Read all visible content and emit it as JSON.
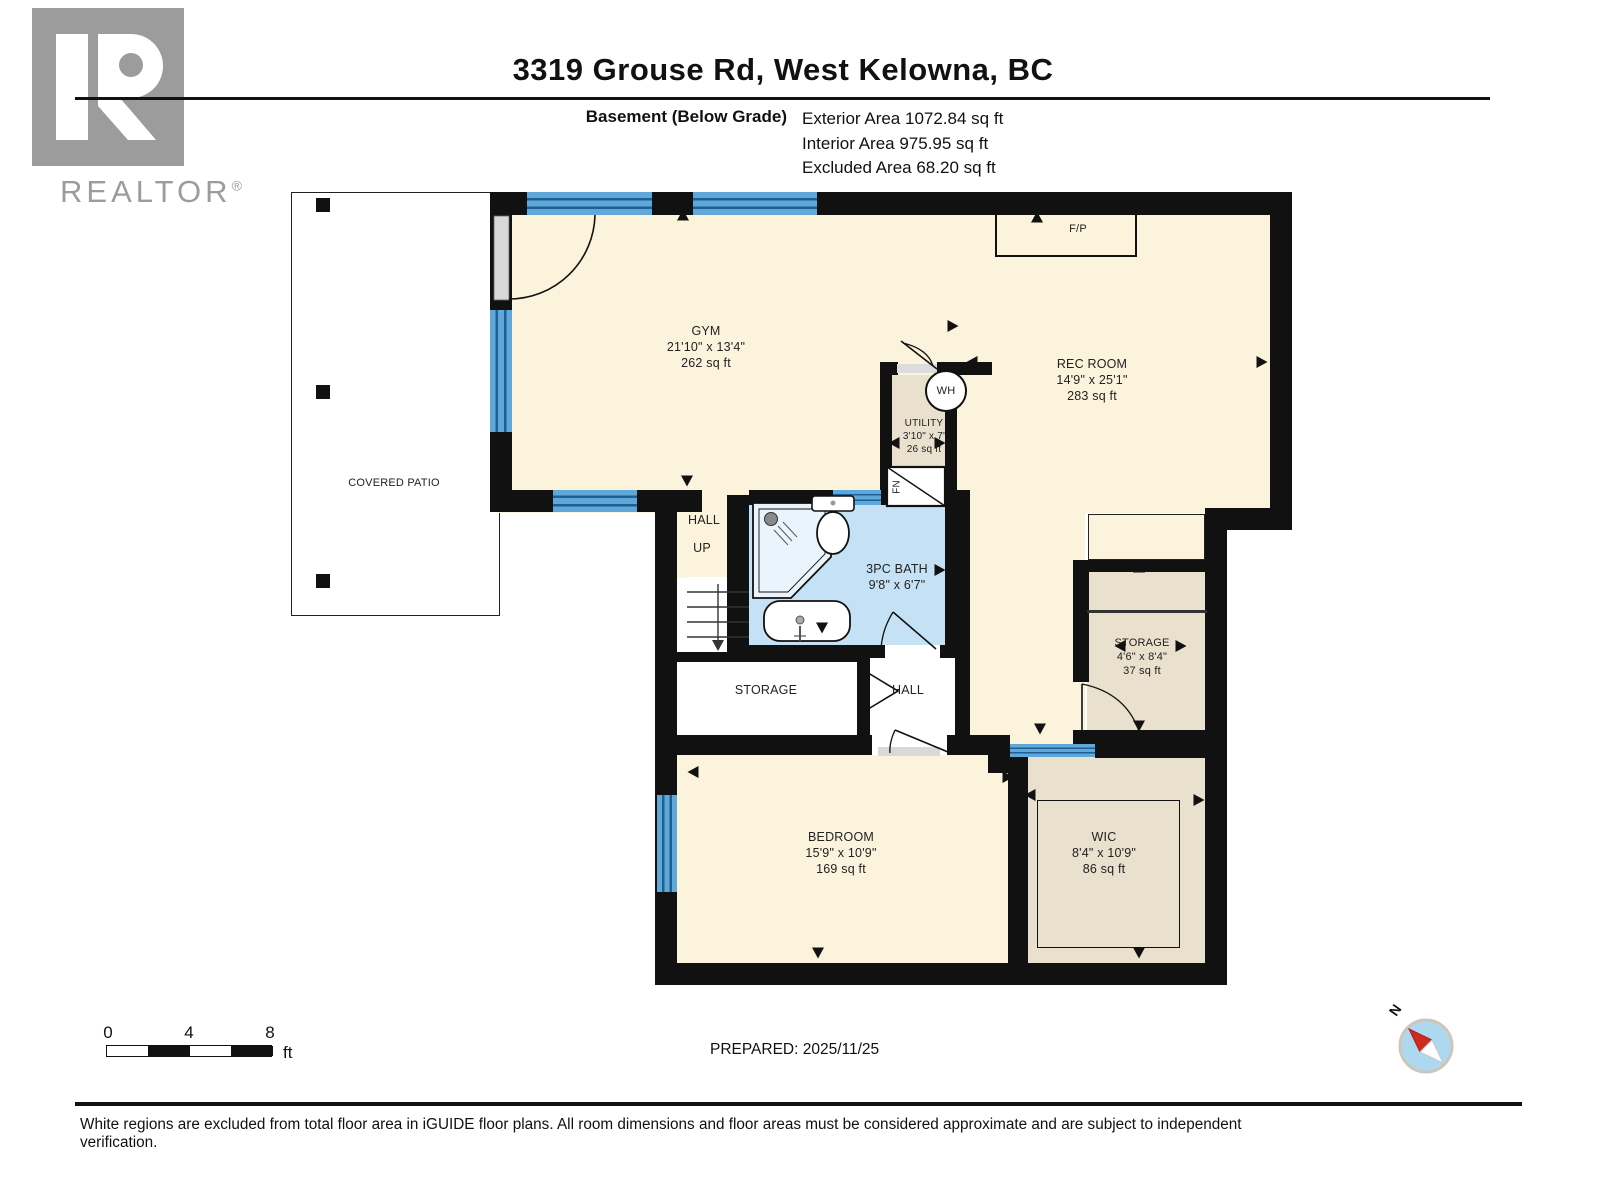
{
  "header": {
    "title": "3319 Grouse Rd, West Kelowna, BC",
    "floor_label": "Basement (Below Grade)",
    "stats": [
      "Exterior Area 1072.84 sq ft",
      "Interior Area 975.95 sq ft",
      "Excluded Area 68.20 sq ft"
    ],
    "logo_word": "REALTOR",
    "logo_reg": "®"
  },
  "rooms": {
    "gym": {
      "name": "GYM",
      "dims": "21'10\" x 13'4\"",
      "area": "262 sq ft"
    },
    "rec_room": {
      "name": "REC ROOM",
      "dims": "14'9\" x 25'1\"",
      "area": "283 sq ft"
    },
    "utility": {
      "name": "UTILITY",
      "dims": "3'10\" x 7'",
      "area": "26 sq ft"
    },
    "bath": {
      "name": "3PC BATH",
      "dims": "9'8\" x 6'7\""
    },
    "hall_upper": {
      "name": "HALL",
      "up": "UP"
    },
    "storage_left": {
      "name": "STORAGE"
    },
    "hall_lower": {
      "name": "HALL"
    },
    "storage_right": {
      "name": "STORAGE",
      "dims": "4'6\" x 8'4\"",
      "area": "37 sq ft"
    },
    "bedroom": {
      "name": "BEDROOM",
      "dims": "15'9\" x 10'9\"",
      "area": "169 sq ft"
    },
    "wic": {
      "name": "WIC",
      "dims": "8'4\" x 10'9\"",
      "area": "86 sq ft"
    },
    "covered_patio": {
      "name": "COVERED PATIO"
    },
    "fireplace": {
      "name": "F/P"
    },
    "water_heater": {
      "name": "WH"
    },
    "furnace": {
      "name": "FN"
    }
  },
  "arrows": [
    {
      "x": 687,
      "y": 481,
      "dir": "down"
    },
    {
      "x": 683,
      "y": 215,
      "dir": "up"
    },
    {
      "x": 1037,
      "y": 217,
      "dir": "up"
    },
    {
      "x": 953,
      "y": 326,
      "dir": "right"
    },
    {
      "x": 972,
      "y": 362,
      "dir": "left"
    },
    {
      "x": 894,
      "y": 443,
      "dir": "left"
    },
    {
      "x": 940,
      "y": 443,
      "dir": "right"
    },
    {
      "x": 1262,
      "y": 362,
      "dir": "right"
    },
    {
      "x": 940,
      "y": 570,
      "dir": "right"
    },
    {
      "x": 822,
      "y": 628,
      "dir": "down"
    },
    {
      "x": 1139,
      "y": 567,
      "dir": "up"
    },
    {
      "x": 1120,
      "y": 646,
      "dir": "left"
    },
    {
      "x": 1181,
      "y": 646,
      "dir": "right"
    },
    {
      "x": 1139,
      "y": 726,
      "dir": "down"
    },
    {
      "x": 1040,
      "y": 729,
      "dir": "down"
    },
    {
      "x": 818,
      "y": 747,
      "dir": "up"
    },
    {
      "x": 693,
      "y": 772,
      "dir": "left"
    },
    {
      "x": 1008,
      "y": 777,
      "dir": "right"
    },
    {
      "x": 1030,
      "y": 795,
      "dir": "left"
    },
    {
      "x": 1199,
      "y": 800,
      "dir": "right"
    },
    {
      "x": 818,
      "y": 953,
      "dir": "down"
    },
    {
      "x": 1139,
      "y": 953,
      "dir": "down"
    },
    {
      "x": 1157,
      "y": 740,
      "dir": "down"
    }
  ],
  "footer": {
    "scale_ticks": [
      "0",
      "4",
      "8"
    ],
    "scale_unit": "ft",
    "prepared": "PREPARED: 2025/11/25",
    "compass_n": "N",
    "disclaimer": "White regions are excluded from total floor area in iGUIDE floor plans. All room dimensions and floor areas must be considered approximate and are subject to independent verification."
  },
  "colors": {
    "room_cream": "#FBF3DB",
    "room_tan": "#E9E0CE",
    "bath_blue": "#C5E1F6",
    "window_blue": "#5FA8D8",
    "wall_black": "#111111",
    "logo_gray": "#9C9C9C",
    "compass_blue": "#ACD8F0",
    "compass_red": "#CE2A21"
  }
}
